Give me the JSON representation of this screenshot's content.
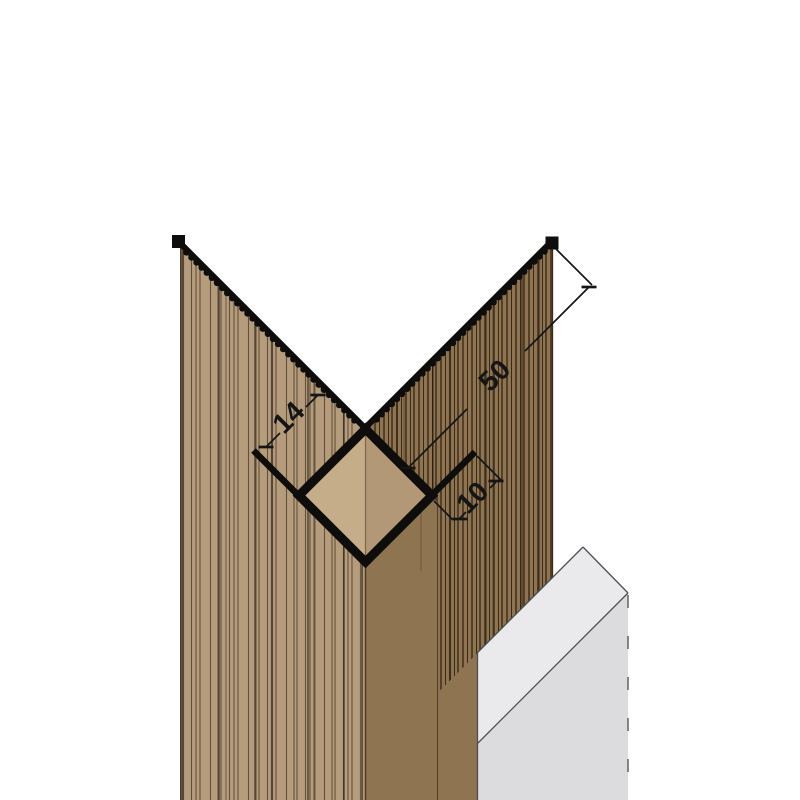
{
  "drawing": {
    "dimension_labels": {
      "upper_left": "14",
      "diagonal": "50",
      "lower_right": "10"
    },
    "colors": {
      "background": "#ffffff",
      "profile_black": "#0e0d0b",
      "panel_left_base": "#b59c7d",
      "panel_right_base": "#8e7451",
      "profile_inner_left": "#c5ad89",
      "profile_inner_right": "#b29877",
      "board_face": "#dcdcdf",
      "board_chamfer": "#eaeaec",
      "board_line": "#4f4f4f",
      "board_hidden_edge": "#696969",
      "dimension_ink": "#151515"
    }
  }
}
